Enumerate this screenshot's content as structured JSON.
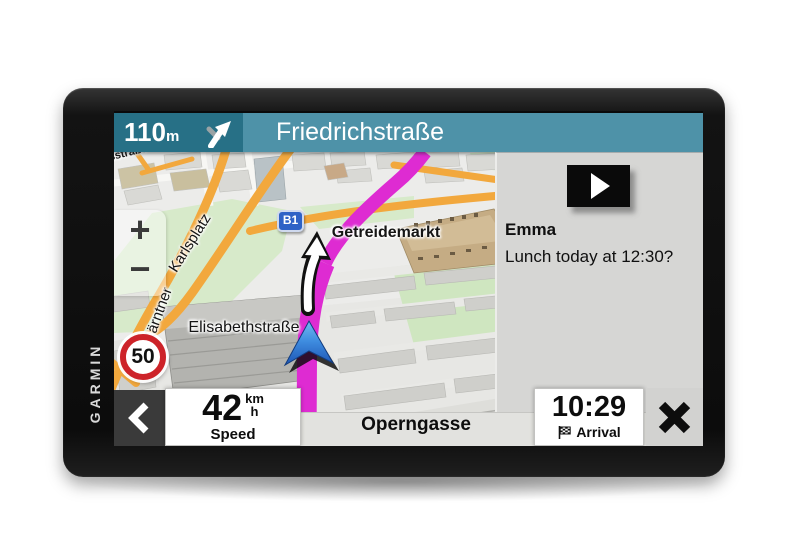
{
  "device": {
    "brand": "GARMIN"
  },
  "navigation_bar": {
    "distance_value": "110",
    "distance_unit": "m",
    "next_street": "Friedrichstraße",
    "turn_icon": "slight-right-fork-arrow"
  },
  "map": {
    "road_badge": "B1",
    "speed_limit": "50",
    "zoom_in_label": "+",
    "zoom_out_label": "−",
    "labels": {
      "partial_street": "sstraße",
      "karlsplatz": "Karlsplatz",
      "kaerntner": "Kärntner",
      "elisabethstrasse": "Elisabethstraße",
      "getreidemarkt": "Getreidemarkt"
    },
    "position_icon": "blue-navigation-arrow",
    "maneuver_icon": "white-turn-arrow"
  },
  "notification_panel": {
    "icon": "play-button",
    "sender": "Emma",
    "message": "Lunch today at 12:30?"
  },
  "status_bar": {
    "back_icon": "chevron-left",
    "speed": {
      "value": "42",
      "unit_top": "km",
      "unit_bottom": "h",
      "label": "Speed"
    },
    "current_street": "Operngasse",
    "arrival": {
      "time": "10:29",
      "label": "Arrival",
      "icon": "checkered-flag"
    },
    "close_icon": "x"
  },
  "colors": {
    "navbar_dark_teal": "#277086",
    "navbar_light_teal": "#4E92A8",
    "route_magenta": "#DE2BD2",
    "panel_gray": "#D6D6D4",
    "speed_sign_red": "#CD2329",
    "road_badge_blue": "#2E62C6",
    "road_orange": "#F2A83D",
    "park_green": "#D7EACA",
    "position_arrow_blue": "#2E6FD0"
  }
}
